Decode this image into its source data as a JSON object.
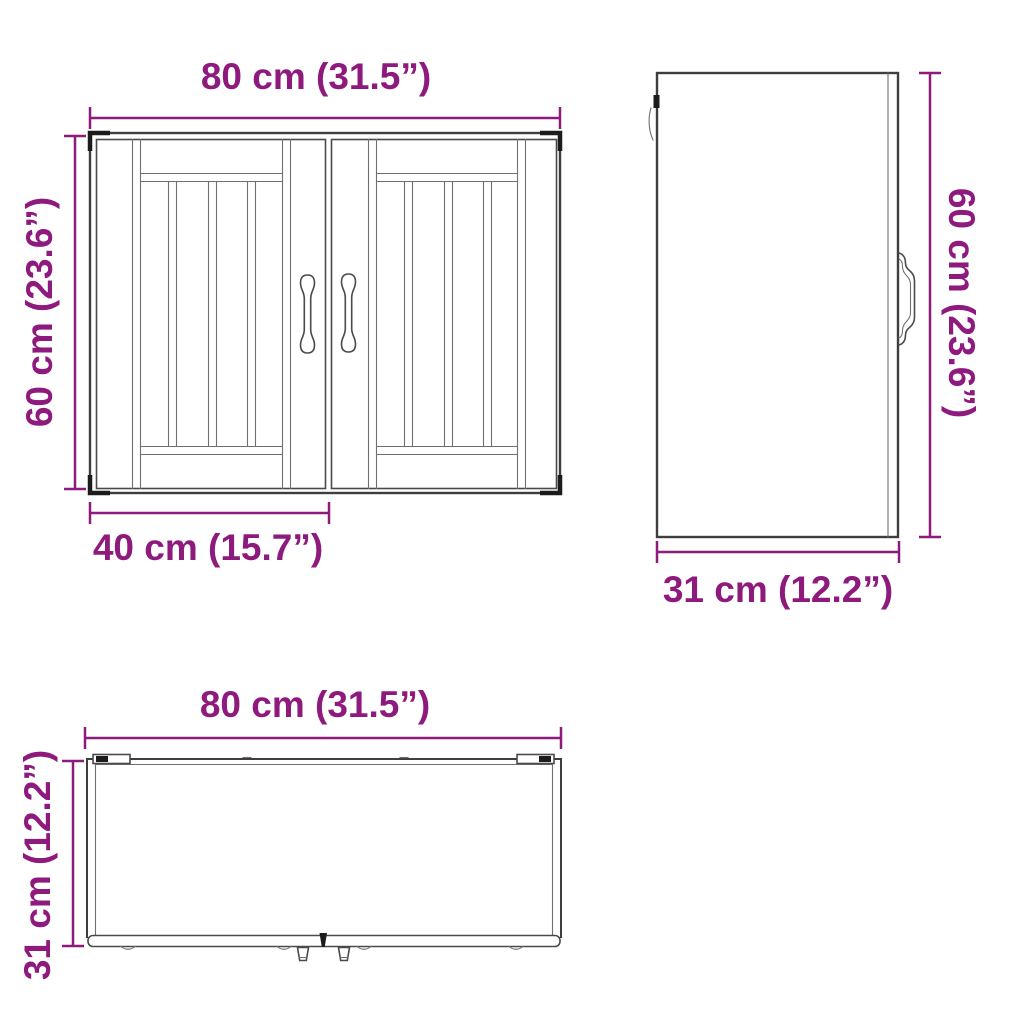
{
  "colors": {
    "accent": "#8e1a7e",
    "line": "#3e3e3e",
    "line_light": "#6f6f6f"
  },
  "views": {
    "front": {
      "width_label": "80 cm (31.5”)",
      "height_label": "60 cm (23.6”)",
      "door_width_label": "40 cm (15.7”)"
    },
    "side": {
      "height_label": "60 cm (23.6”)",
      "depth_label": "31 cm (12.2”)"
    },
    "top": {
      "width_label": "80 cm (31.5”)",
      "depth_label": "31 cm (12.2”)"
    }
  }
}
